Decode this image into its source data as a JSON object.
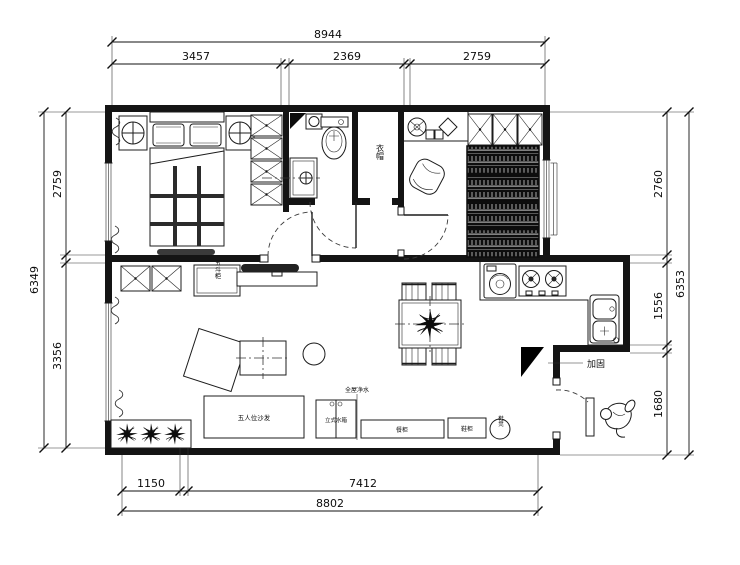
{
  "dimensions": {
    "top": {
      "overall": "8944",
      "segments": [
        "3457",
        "2369",
        "2759"
      ]
    },
    "bottom": {
      "overall": "8802",
      "segments": [
        "1150",
        "7412"
      ]
    },
    "left": {
      "overall": "6349",
      "segments": [
        "2759",
        "3356"
      ]
    },
    "right": {
      "overall": "6353",
      "segments": [
        "2760",
        "1556",
        "1680"
      ]
    }
  },
  "labels": {
    "closet_room": "衣帽",
    "drawer_cabinet": "五斗柜",
    "sofa": "五人位沙发",
    "whole_house_note": "全屋净水",
    "water_tank_cabinet": "立式水箱",
    "sideboard": "餐柜",
    "shoe_cabinet": "鞋柜",
    "shoe_stool": "鞋凳",
    "reinforce_note": "加固"
  }
}
